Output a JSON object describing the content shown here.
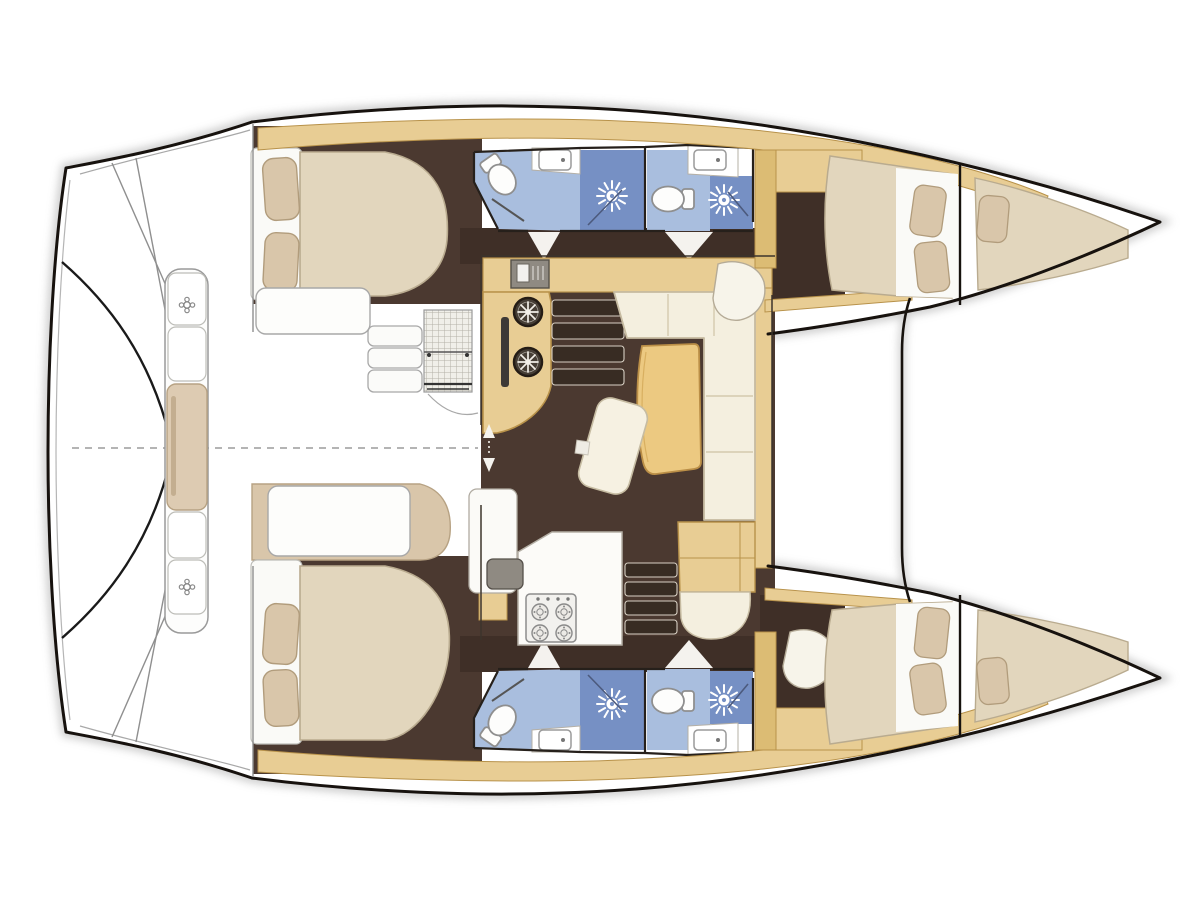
{
  "scene": {
    "kind": "catamaran-interior-floor-plan",
    "orientation": "bow-right",
    "text_labels": []
  },
  "features": {
    "double_cabins": 4,
    "bathrooms": 4,
    "toilets": 4,
    "showers": 4,
    "bathroom_sinks": 4,
    "bow_berths": 2,
    "stair_flights": 2,
    "saloon": {
      "sofa": "L-shaped",
      "tables": 1,
      "chairs": 1,
      "galley_round_burners": 2,
      "stove_burners": 4
    },
    "cockpit": {
      "transom_bench": 1,
      "bench_cleats": 2,
      "mesh_table": 1,
      "step_lockers": 3
    }
  },
  "colors": {
    "floorDark": "#4b3930",
    "floorDark2": "#3f2f27",
    "wood": "#e8cd94",
    "woodShade": "#dcbc74",
    "woodEdge": "#b8924a",
    "mattress": "#e2d6bd",
    "mattressEdge": "#b9ab8f",
    "pillow": "#d9c6aa",
    "pillowEdge": "#b19c7c",
    "cream": "#f4efdf",
    "creamEdge": "#c6bba1",
    "whiteFurn": "#fdfdfb",
    "grayLine": "#9a9a9a",
    "outline": "#17120e",
    "bathLight": "#a9bede",
    "bathMid": "#8ea8d2",
    "bathDark": "#7690c4",
    "bathWall": "#33415f",
    "applianceGray": "#8f8a82",
    "stepFill": "#382c23",
    "stepEdge": "#d8d0c4",
    "tableWood": "#ecc981",
    "tableEdge": "#bb8f47",
    "shadow": "#a3a3a3",
    "wallLine": "#26201b"
  }
}
